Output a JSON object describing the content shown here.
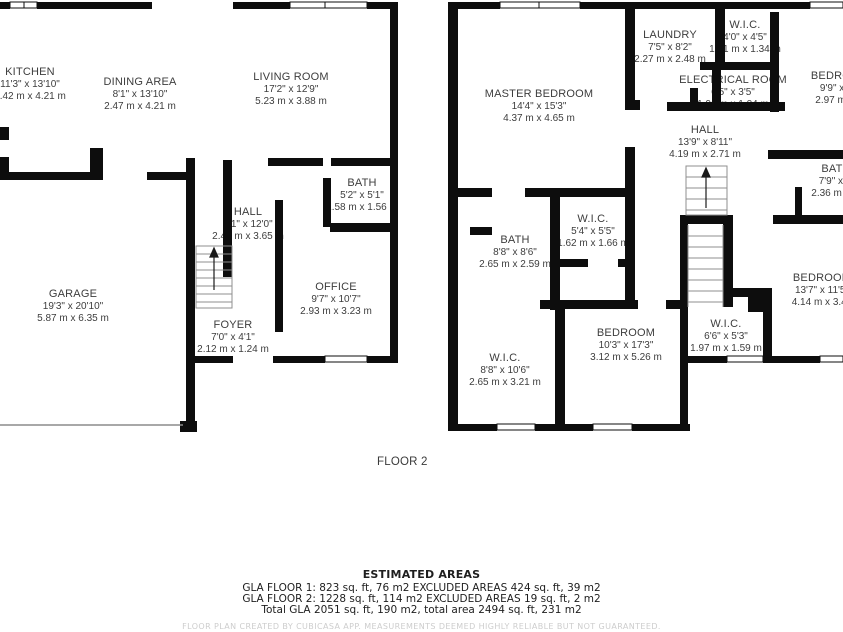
{
  "floor1": {
    "rooms": [
      {
        "name": "KITCHEN",
        "imperial": "11'3\" x 13'10\"",
        "metric": "3.42 m x 4.21 m"
      },
      {
        "name": "DINING AREA",
        "imperial": "8'1\" x 13'10\"",
        "metric": "2.47 m x 4.21 m"
      },
      {
        "name": "LIVING ROOM",
        "imperial": "17'2\" x 12'9\"",
        "metric": "5.23 m x 3.88 m"
      },
      {
        "name": "BATH",
        "imperial": "5'2\" x 5'1\"",
        "metric": "1.58 m x 1.56 m"
      },
      {
        "name": "HALL",
        "imperial": "8'1\" x 12'0\"",
        "metric": "2.46 m x 3.65 m"
      },
      {
        "name": "OFFICE",
        "imperial": "9'7\" x 10'7\"",
        "metric": "2.93 m x 3.23 m"
      },
      {
        "name": "FOYER",
        "imperial": "7'0\" x 4'1\"",
        "metric": "2.12 m x 1.24 m"
      },
      {
        "name": "GARAGE",
        "imperial": "19'3\" x 20'10\"",
        "metric": "5.87 m x 6.35 m"
      }
    ]
  },
  "floor2": {
    "caption": "FLOOR 2",
    "rooms": [
      {
        "name": "MASTER BEDROOM",
        "imperial": "14'4\" x 15'3\"",
        "metric": "4.37 m x 4.65 m"
      },
      {
        "name": "LAUNDRY",
        "imperial": "7'5\" x 8'2\"",
        "metric": "2.27 m x 2.48 m"
      },
      {
        "name": "W.I.C.",
        "imperial": "4'0\" x 4'5\"",
        "metric": "1.21 m x 1.34 m"
      },
      {
        "name": "ELECTRICAL ROOM",
        "imperial": "6'5\" x 3'5\"",
        "metric": "1.96 m x 1.04 m"
      },
      {
        "name": "BEDROOM",
        "imperial": "9'9\" x 12'",
        "metric": "2.97 m x 3."
      },
      {
        "name": "HALL",
        "imperial": "13'9\" x 8'11\"",
        "metric": "4.19 m x 2.71 m"
      },
      {
        "name": "BATH",
        "imperial": "7'9\" x 5'",
        "metric": "2.36 m x 1."
      },
      {
        "name": "W.I.C.",
        "imperial": "5'4\" x 5'5\"",
        "metric": "1.62 m x 1.66 m"
      },
      {
        "name": "BATH",
        "imperial": "8'8\" x 8'6\"",
        "metric": "2.65 m x 2.59 m"
      },
      {
        "name": "BEDROOM",
        "imperial": "10'3\" x 17'3\"",
        "metric": "3.12 m x 5.26 m"
      },
      {
        "name": "W.I.C.",
        "imperial": "8'8\" x 10'6\"",
        "metric": "2.65 m x 3.21 m"
      },
      {
        "name": "W.I.C.",
        "imperial": "6'6\" x 5'3\"",
        "metric": "1.97 m x 1.59 m"
      },
      {
        "name": "BEDROOM",
        "imperial": "13'7\" x 11'5\"",
        "metric": "4.14 m x 3.48"
      }
    ]
  },
  "footer": {
    "estimated_title": "ESTIMATED AREAS",
    "line1": "GLA FLOOR 1: 823 sq. ft, 76 m2 EXCLUDED AREAS 424 sq. ft, 39 m2",
    "line2": "GLA FLOOR 2: 1228 sq. ft, 114 m2 EXCLUDED AREAS 19 sq. ft, 2 m2",
    "line3": "Total GLA 2051 sq. ft, 190 m2, total area 2494 sq. ft, 231 m2",
    "disclaimer": "FLOOR PLAN CREATED BY CUBICASA APP. MEASUREMENTS DEEMED HIGHLY RELIABLE BUT NOT GUARANTEED."
  }
}
